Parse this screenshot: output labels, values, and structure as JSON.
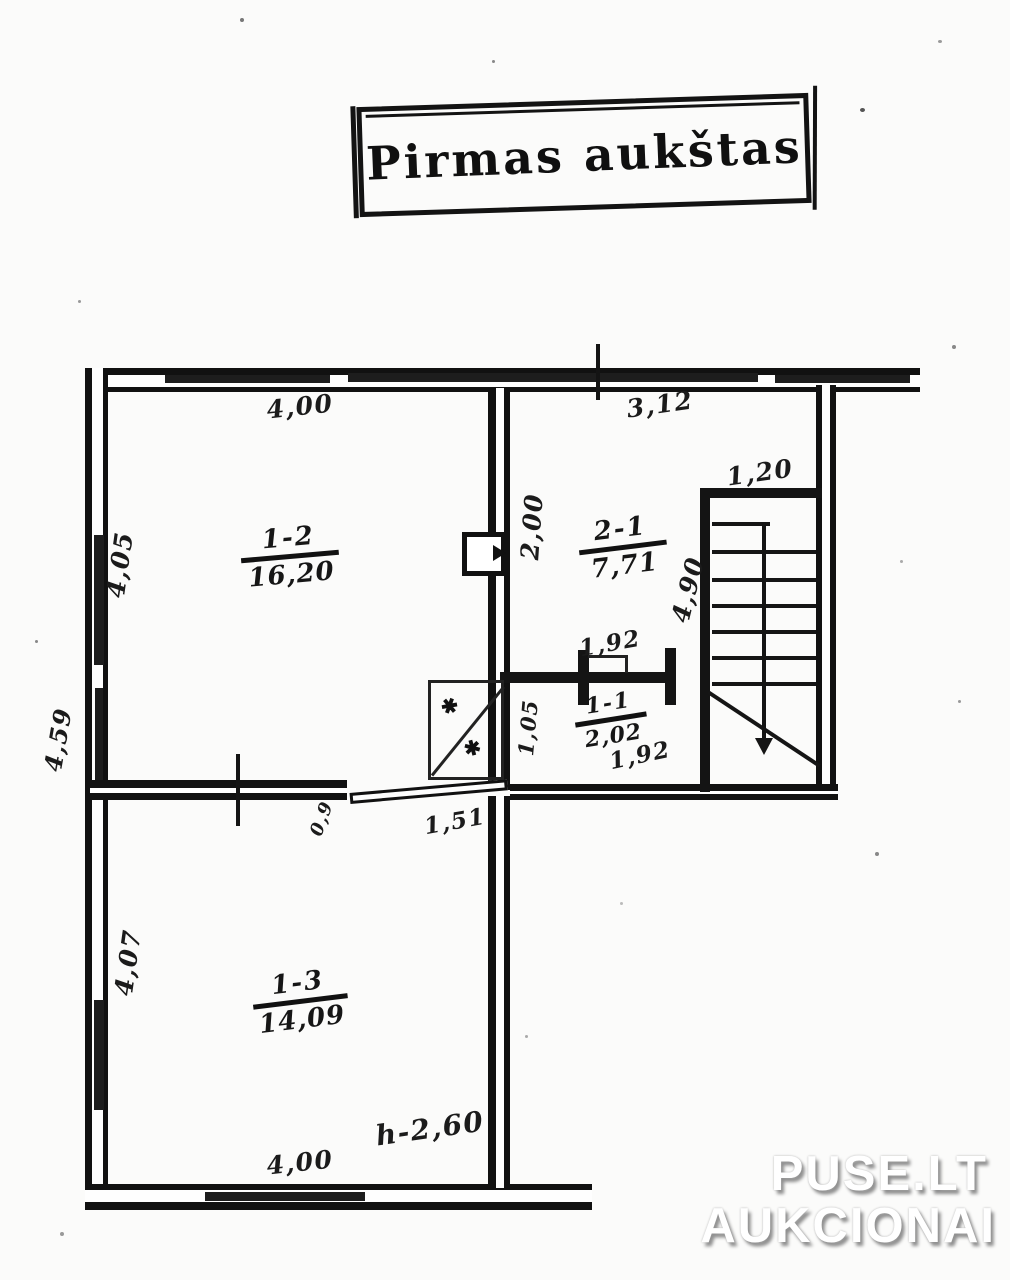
{
  "title": "Pirmas aukštas",
  "rooms": [
    {
      "id": "1-2",
      "area": "16,20"
    },
    {
      "id": "2-1",
      "area": "7,71"
    },
    {
      "id": "1-1",
      "area": "2,02"
    },
    {
      "id": "1-3",
      "area": "14,09"
    }
  ],
  "dimensions": {
    "room12_width_top": "4,00",
    "hall_width_top": "3,12",
    "stairs_width": "1,20",
    "room12_height": "4,05",
    "mid_wall_height": "2,00",
    "stairs_height": "4,90",
    "hall_door_width": "1,92",
    "room11_width": "1,92",
    "room11_height": "1,05",
    "outer_left_height": "4,59",
    "door_width": "1,51",
    "door_leaf_width": "0,9",
    "room13_height": "4,07",
    "room13_width_bottom": "4,00",
    "ceiling_height": "h-2,60"
  },
  "symbols": {
    "hatch_mark": "✱"
  },
  "watermark": {
    "line1": "PUSE.LT",
    "line2": "AUKCIONAI"
  }
}
